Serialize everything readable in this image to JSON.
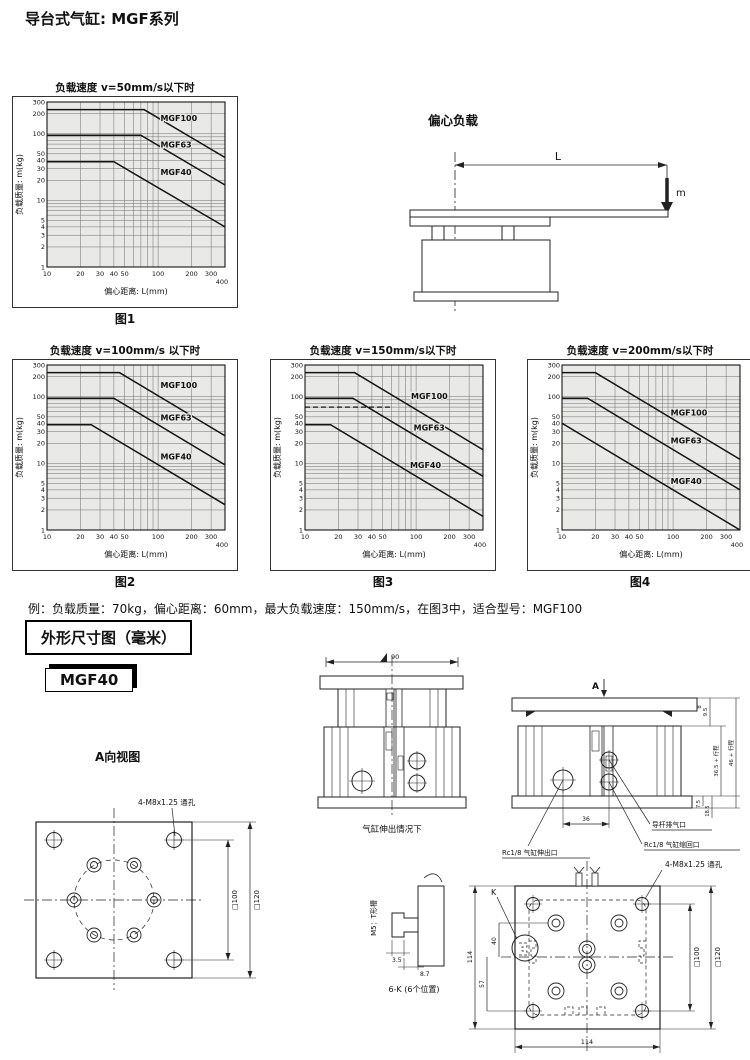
{
  "page": {
    "title": "导台式气缸: MGF系列"
  },
  "eccentric": {
    "title": "偏心负载",
    "dim_label": "L",
    "mass_label": "m"
  },
  "example": {
    "text": "例：负载质量：70kg，偏心距离：60mm，最大负载速度：150mm/s，在图3中，适合型号：MGF100"
  },
  "section2": {
    "header": "外形尺寸图（毫米）"
  },
  "model_badge": {
    "label": "MGF40"
  },
  "chart_data": [
    {
      "type": "line",
      "title": "负载速度 v=50mm/s以下时",
      "caption": "图1",
      "xlabel": "偏心距离: L(mm)",
      "ylabel": "负载质量: m(kg)",
      "xscale": "log",
      "yscale": "log",
      "xlim": [
        10,
        400
      ],
      "ylim": [
        1,
        300
      ],
      "xticks": [
        10,
        20,
        30,
        40,
        50,
        100,
        200,
        300,
        400
      ],
      "yticks": [
        1,
        2,
        3,
        4,
        5,
        10,
        20,
        30,
        40,
        50,
        100,
        200,
        300
      ],
      "grid": true,
      "series": [
        {
          "name": "MGF100",
          "x": [
            10,
            75,
            400
          ],
          "y": [
            230,
            230,
            44
          ],
          "label_at": [
            105,
            155
          ]
        },
        {
          "name": "MGF63",
          "x": [
            10,
            70,
            400
          ],
          "y": [
            95,
            95,
            17
          ],
          "label_at": [
            105,
            62
          ]
        },
        {
          "name": "MGF40",
          "x": [
            10,
            40,
            400
          ],
          "y": [
            38,
            38,
            4
          ],
          "label_at": [
            105,
            24
          ]
        }
      ]
    },
    {
      "type": "line",
      "title": "负载速度 v=100mm/s 以下时",
      "caption": "图2",
      "xlabel": "偏心距离: L(mm)",
      "ylabel": "负载质量: m(kg)",
      "xscale": "log",
      "yscale": "log",
      "xlim": [
        10,
        400
      ],
      "ylim": [
        1,
        300
      ],
      "xticks": [
        10,
        20,
        30,
        40,
        50,
        100,
        200,
        300,
        400
      ],
      "yticks": [
        1,
        2,
        3,
        4,
        5,
        10,
        20,
        30,
        40,
        50,
        100,
        200,
        300
      ],
      "grid": true,
      "series": [
        {
          "name": "MGF100",
          "x": [
            10,
            45,
            400
          ],
          "y": [
            230,
            230,
            26
          ],
          "label_at": [
            105,
            135
          ]
        },
        {
          "name": "MGF63",
          "x": [
            10,
            40,
            400
          ],
          "y": [
            95,
            95,
            9.5
          ],
          "label_at": [
            105,
            44
          ]
        },
        {
          "name": "MGF40",
          "x": [
            10,
            25,
            400
          ],
          "y": [
            38,
            38,
            2.4
          ],
          "label_at": [
            105,
            11.5
          ]
        }
      ]
    },
    {
      "type": "line",
      "title": "负载速度 v=150mm/s以下时",
      "caption": "图3",
      "xlabel": "偏心距离: L(mm)",
      "ylabel": "负载质量: m(kg)",
      "xscale": "log",
      "yscale": "log",
      "xlim": [
        10,
        400
      ],
      "ylim": [
        1,
        300
      ],
      "xticks": [
        10,
        20,
        30,
        40,
        50,
        100,
        200,
        300,
        400
      ],
      "yticks": [
        1,
        2,
        3,
        4,
        5,
        10,
        20,
        30,
        40,
        50,
        100,
        200,
        300
      ],
      "grid": true,
      "guide": {
        "y": 70,
        "x": [
          10,
          62
        ],
        "style": "dashed"
      },
      "series": [
        {
          "name": "MGF100",
          "x": [
            10,
            28,
            400
          ],
          "y": [
            230,
            230,
            16
          ],
          "label_at": [
            90,
            92
          ]
        },
        {
          "name": "MGF63",
          "x": [
            10,
            27,
            400
          ],
          "y": [
            95,
            95,
            6.4
          ],
          "label_at": [
            95,
            31
          ]
        },
        {
          "name": "MGF40",
          "x": [
            10,
            17,
            400
          ],
          "y": [
            38,
            38,
            1.6
          ],
          "label_at": [
            88,
            8.6
          ]
        }
      ]
    },
    {
      "type": "line",
      "title": "负载速度 v=200mm/s以下时",
      "caption": "图4",
      "xlabel": "偏心距离: L(mm)",
      "ylabel": "负载质量: m(kg)",
      "xscale": "log",
      "yscale": "log",
      "xlim": [
        10,
        400
      ],
      "ylim": [
        1,
        300
      ],
      "xticks": [
        10,
        20,
        30,
        40,
        50,
        100,
        200,
        300,
        400
      ],
      "yticks": [
        1,
        2,
        3,
        4,
        5,
        10,
        20,
        30,
        40,
        50,
        100,
        200,
        300
      ],
      "grid": true,
      "series": [
        {
          "name": "MGF100",
          "x": [
            10,
            20,
            400
          ],
          "y": [
            230,
            230,
            11.5
          ],
          "label_at": [
            95,
            52
          ]
        },
        {
          "name": "MGF63",
          "x": [
            10,
            17,
            400
          ],
          "y": [
            95,
            95,
            4
          ],
          "label_at": [
            95,
            20
          ]
        },
        {
          "name": "MGF40",
          "x": [
            10,
            400
          ],
          "y": [
            40,
            1
          ],
          "label_at": [
            95,
            4.9
          ]
        }
      ]
    }
  ],
  "drawings": {
    "view_a": {
      "label": "A向视图",
      "hole_note": "4-M8x1.25 通孔",
      "dim_100": "□100",
      "dim_120": "□120"
    },
    "extended": {
      "dim_width": "90",
      "caption": "气缸伸出情况下"
    },
    "side_view": {
      "arrow_label": "A",
      "dim_plate": "8",
      "dim_9_5": "9.5",
      "dim_body": "36.5 + 行程",
      "dim_total": "46 + 行程",
      "dim_7_5": "7.5",
      "dim_18_5": "18.5",
      "dim_ports": "36",
      "label_extend_port": "Rc1/8 气缸伸出口",
      "label_guide_port": "导杆排气口",
      "label_retract_port": "Rc1/8 气缸缩回口"
    },
    "t_slot": {
      "label": "M5：T形槽",
      "dim_3_5": "3.5",
      "dim_8_7": "8.7",
      "caption": "6-K (6个位置)"
    },
    "top_view": {
      "hole_note": "4-M8x1.25 通孔",
      "k_label": "K",
      "dim_height": "114",
      "dim_40": "40",
      "dim_57": "57",
      "dim_100": "□100",
      "dim_120": "□120",
      "dim_width": "114"
    }
  }
}
